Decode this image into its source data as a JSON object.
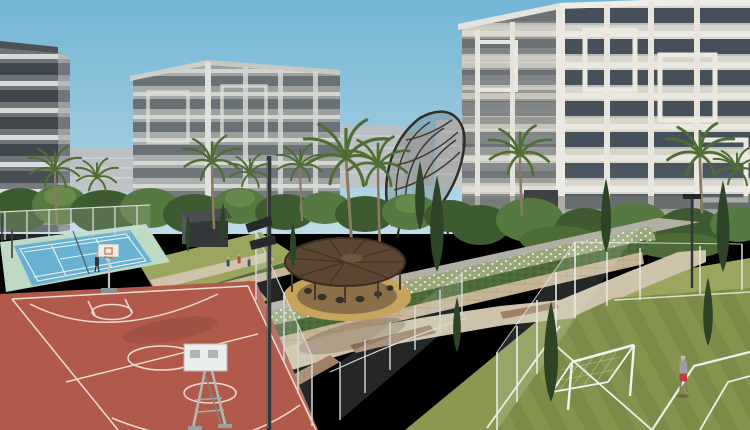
{
  "meta": {
    "scene_type": "architectural-render",
    "description": "Residential compound render: apartment buildings behind landscaped gardens, tennis court, basketball court, football pitch, circular pergola seating area"
  },
  "palette": {
    "sky": "#73b5d5",
    "sky_horizon": "#b5d7e4",
    "distant_building": "#b9bfc2",
    "right_wall": "#d7d4ca",
    "right_side": "#c9c6bb",
    "mid_wall": "#a8acaa",
    "mid_side": "#9aa09e",
    "left_wall": "#6d7377",
    "left_side": "#989ea1",
    "roof_dark": "#4c5154",
    "tree_dark": "#3d5a30",
    "tree_mid": "#567841",
    "tree_light": "#7c9a55",
    "palm_frond": "#4e6e34",
    "trunk": "#8c7b60",
    "cypress": "#2d4426",
    "hedge": "#4c6b38",
    "flower_hedge": "#99a77a",
    "stone_wall": "#c5b497",
    "road": "#b2afa7",
    "lawn": "#9ba55d",
    "lawn_dark": "#8a9850",
    "path": "#cfc3ab",
    "paver": "#9f8166",
    "pergola_wood": "#5a4632",
    "pergola_floor": "#c7a45e",
    "pergola_inner": "#8a6f49",
    "tennis_blue": "#68b1d2",
    "tennis_apron": "#bed9c4",
    "tennis_line": "#e9f2f4",
    "court_red": "#b15a4b",
    "court_line": "#ecddd5",
    "field_green": "#7d8b48",
    "field_stripe": "#8b9a50",
    "field_line": "#eef0e8",
    "goal_white": "#f2f4f0",
    "fence_white": "#e9ebe7",
    "fence_gray": "#d4d8d6",
    "mesh": "rgba(228,234,237,0.16)",
    "pole_dark": "#34373a",
    "floodlight": "#26292b",
    "backboard": "#ebedeb",
    "hoop_orange": "#d8693a",
    "kiosk_roof": "#4a4e51",
    "kiosk_body": "#33373a",
    "skin": "#c9a886",
    "shirt_gray": "#9aa0a2",
    "shorts_red": "#b7413b",
    "figure_dark": "#34302b",
    "shadow": "rgba(60,30,25,0.22)"
  },
  "scene": {
    "buildings": [
      "apartment-building-left",
      "apartment-building-middle",
      "apartment-building-right",
      "distant-buildings"
    ],
    "amenities": [
      "tennis-court",
      "basketball-court",
      "football-field",
      "pergola-seating-area",
      "walking-paths",
      "garden-terraces",
      "kiosk"
    ],
    "structures": [
      "lattice-sculpture",
      "floodlight-pole",
      "sports-fencing",
      "football-goal",
      "basketball-hoops"
    ],
    "vegetation": [
      "palm-trees",
      "cypress-trees",
      "hedges",
      "flowering-shrubs",
      "lawns"
    ],
    "people": [
      {
        "label": "tennis-player",
        "count": 1
      },
      {
        "label": "football-player",
        "count": 1
      },
      {
        "label": "pedestrians",
        "count": 3
      },
      {
        "label": "pergola-visitors",
        "count": 6
      }
    ]
  }
}
